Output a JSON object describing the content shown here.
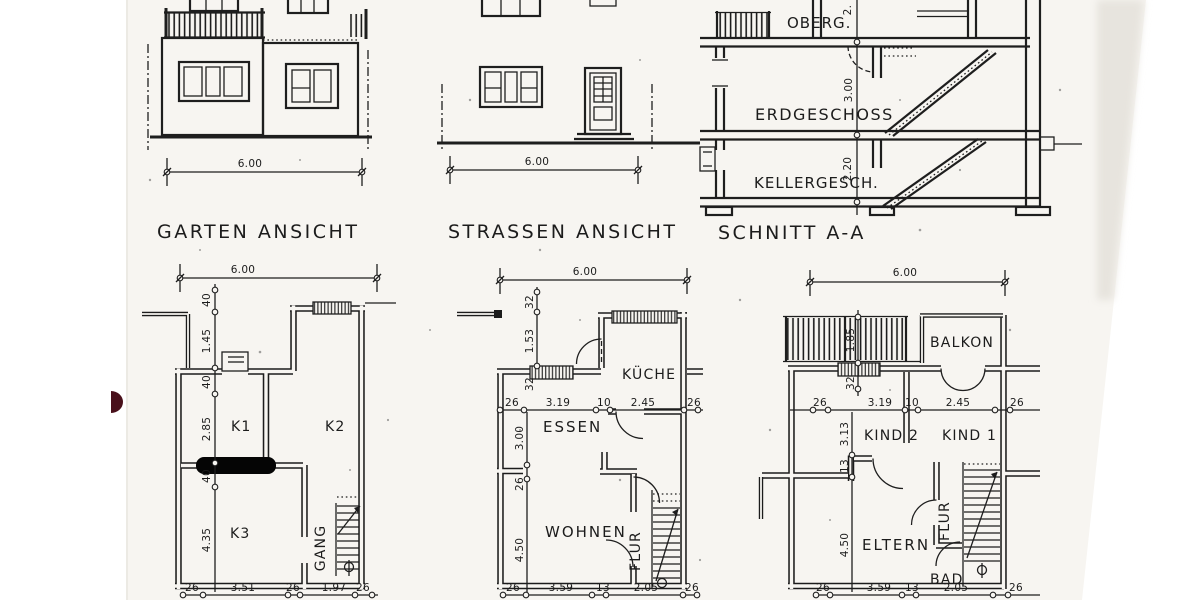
{
  "meta": {
    "kind": "scanned architectural drawing, German residence plans",
    "paper_color": "#f7f5f1",
    "ink_color": "#1c1c1c",
    "redaction_color": "#050505",
    "red_mark_color": "#49101b"
  },
  "elevations": {
    "garten": {
      "title": "GARTEN ANSICHT",
      "width_dim": "6.00"
    },
    "strassen": {
      "title": "STRASSEN ANSICHT",
      "width_dim": "6.00"
    },
    "schnitt": {
      "title": "SCHNITT A-A",
      "floors": [
        {
          "label": "OBERG.",
          "height_dim": "2."
        },
        {
          "label": "ERDGESCHOSS",
          "height_dim": "3.00"
        },
        {
          "label": "KELLERGESCH.",
          "height_dim": "2.20"
        }
      ]
    }
  },
  "plans": {
    "keller": {
      "width_dim": "6.00",
      "rooms": {
        "k1": "K1",
        "k2": "K2",
        "k3": "K3",
        "gang": "GANG"
      },
      "left_dims": [
        "40",
        "1.45",
        "40",
        "2.85",
        "40",
        "4.35"
      ],
      "bottom_dims": [
        "26",
        "3.51",
        "26",
        "1.97",
        "26"
      ]
    },
    "erdgeschoss": {
      "width_dim": "6.00",
      "rooms": {
        "kueche": "KÜCHE",
        "essen": "ESSEN",
        "wohnen": "WOHNEN",
        "flur": "FLUR"
      },
      "upper_left_dims": [
        "32",
        "1.53",
        "32"
      ],
      "lower_left_dims": [
        "3.00",
        "26",
        "4.50"
      ],
      "mid_dims": [
        "26",
        "3.19",
        "10",
        "2.45",
        "26"
      ],
      "bottom_dims": [
        "26",
        "3.59",
        "13",
        "2.05",
        "26"
      ]
    },
    "obergeschoss": {
      "width_dim": "6.00",
      "rooms": {
        "balkon": "BALKON",
        "kind2": "KIND 2",
        "kind1": "KIND 1",
        "eltern": "ELTERN",
        "bad": "BAD",
        "flur": "FLUR"
      },
      "upper_left_dims": [
        "1.85",
        "32"
      ],
      "lower_left_dims": [
        "3.13",
        "13",
        "4.50"
      ],
      "mid_dims": [
        "26",
        "3.19",
        "10",
        "2.45",
        "26"
      ],
      "bottom_dims": [
        "26",
        "3.59",
        "13",
        "2.05",
        "26"
      ]
    }
  }
}
